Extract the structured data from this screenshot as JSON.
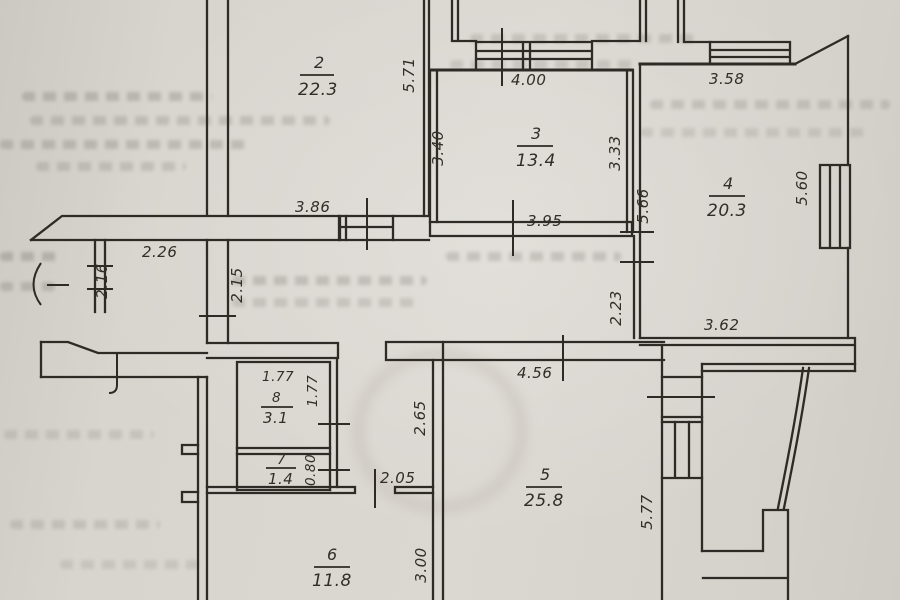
{
  "colors": {
    "paper": "#d8d4ce",
    "ink": "#2e2a25"
  },
  "plan_title": "apartment floor plan (scanned hand drawing)",
  "rooms": [
    {
      "number": "2",
      "area": "22.3"
    },
    {
      "number": "3",
      "area": "13.4"
    },
    {
      "number": "4",
      "area": "20.3"
    },
    {
      "number": "5",
      "area": "25.8"
    },
    {
      "number": "6",
      "area": "11.8"
    },
    {
      "number": "7",
      "area": "1.4"
    },
    {
      "number": "8",
      "area": "3.1"
    }
  ],
  "dims": {
    "room2_side": "5.71",
    "room2_bottom": "3.86",
    "room3_top": "4.00",
    "room3_left": "3.40",
    "room3_right": "3.33",
    "room3_bottom": "3.95",
    "room4_top": "3.58",
    "room4_left": "5.66",
    "room4_right": "5.60",
    "room4_bottom": "3.62",
    "room4_lower_left": "2.23",
    "entry_width": "2.26",
    "entry_left": "2.16",
    "corridor_left": "2.15",
    "room8_top": "1.77",
    "room8_right": "1.77",
    "room7_right": "0.80",
    "hall_right": "2.65",
    "hall_bottom": "2.05",
    "room5_top": "4.56",
    "room5_right": "5.77",
    "room6_right": "3.00"
  }
}
